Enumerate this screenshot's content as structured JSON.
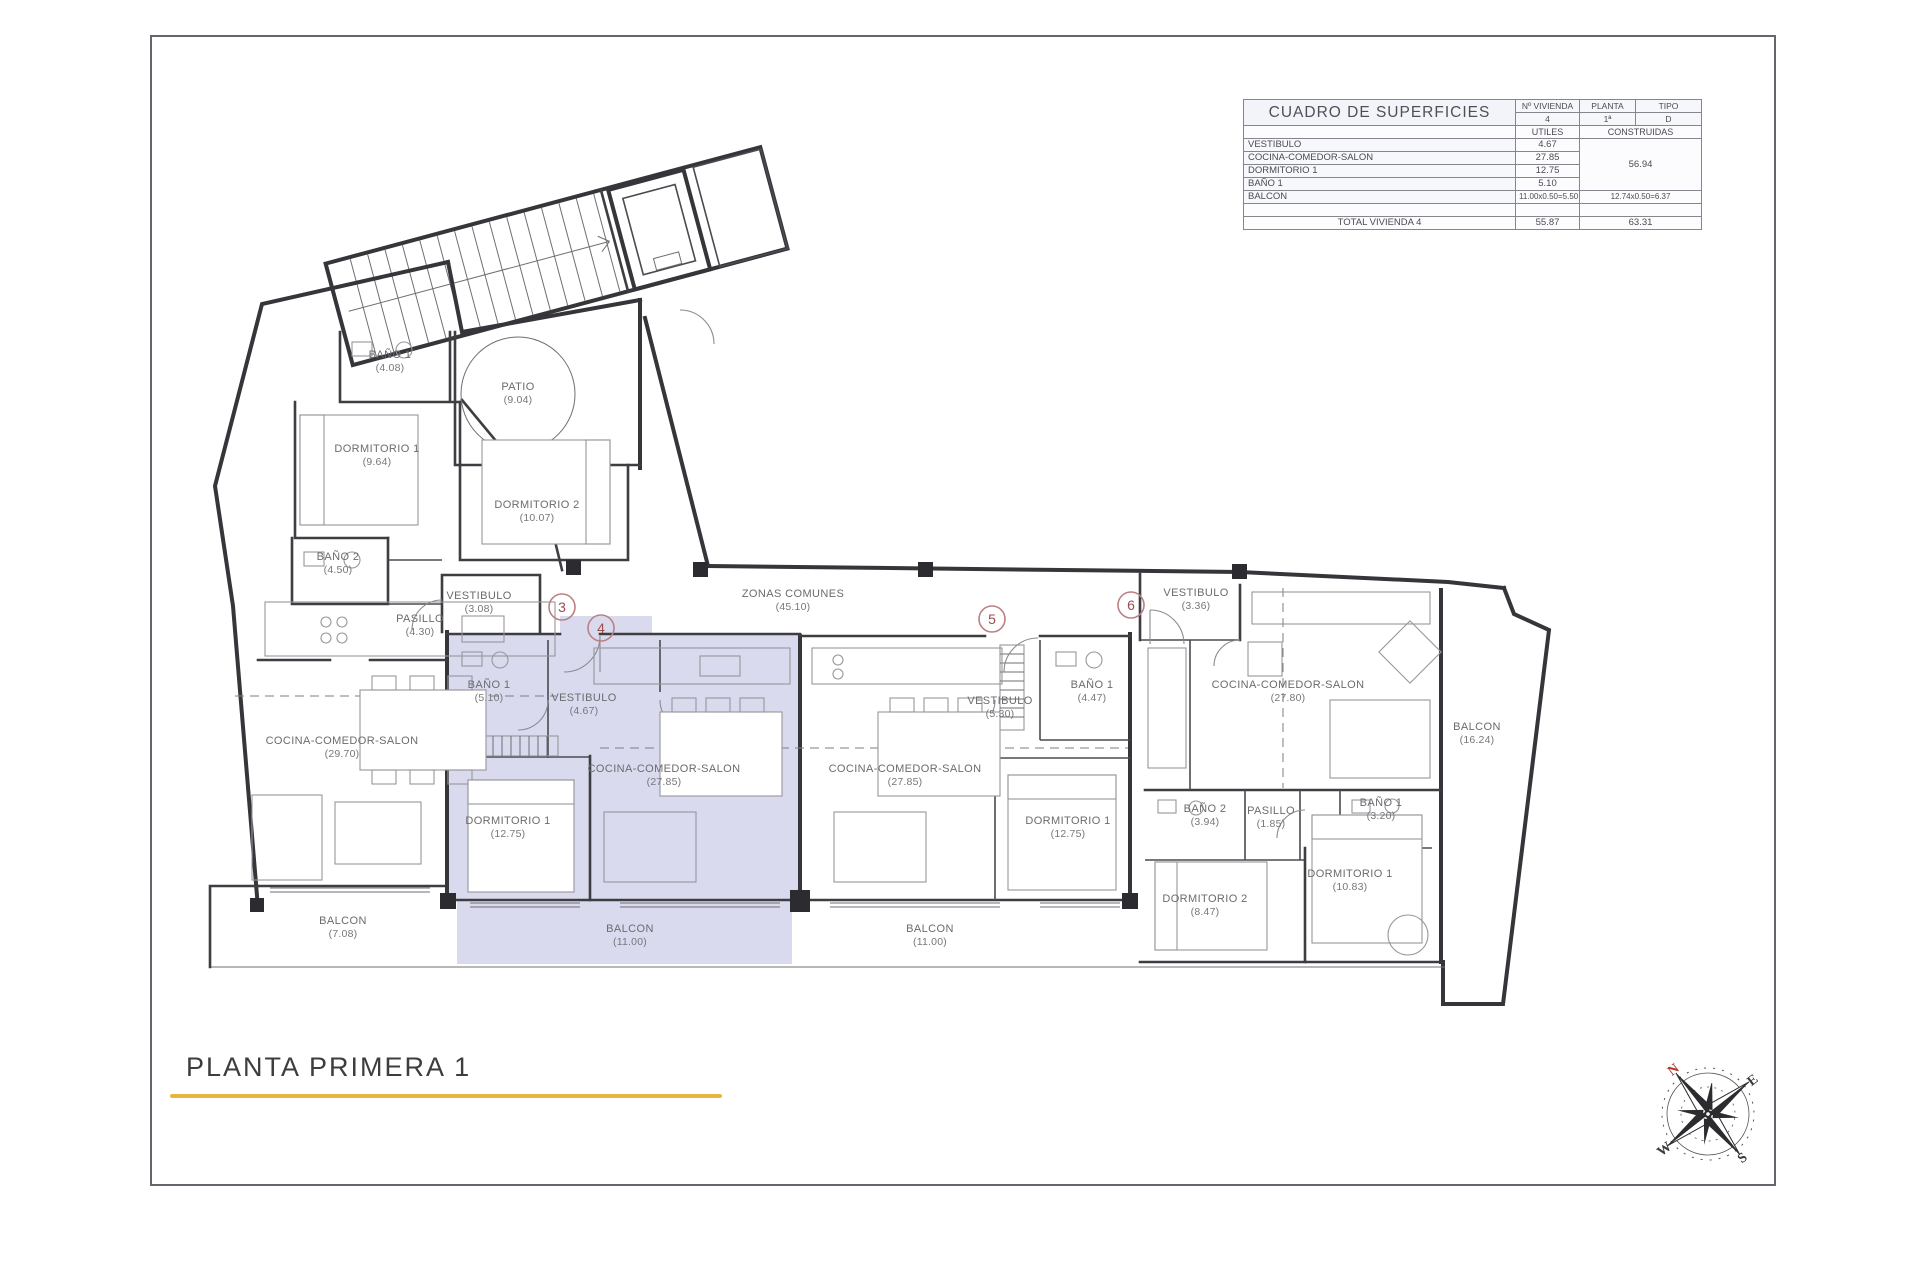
{
  "title_block": {
    "title": "PLANTA PRIMERA 1",
    "underline_color": "#e6b63d"
  },
  "surface_table": {
    "title": "CUADRO DE SUPERFICIES",
    "col_headers": [
      "Nº VIVIENDA",
      "PLANTA",
      "TIPO"
    ],
    "col_values": [
      "4",
      "1ª",
      "D"
    ],
    "subheaders": [
      "UTILES",
      "CONSTRUIDAS"
    ],
    "rows": [
      {
        "name": "VESTIBULO",
        "utiles": "4.67"
      },
      {
        "name": "COCINA-COMEDOR-SALON",
        "utiles": "27.85"
      },
      {
        "name": "DORMITORIO 1",
        "utiles": "12.75"
      },
      {
        "name": "BAÑO 1",
        "utiles": "5.10"
      }
    ],
    "construidas_merged": "56.94",
    "balcon_row": {
      "name": "BALCON",
      "utiles": "11.00x0.50=5.50",
      "construidas": "12.74x0.50=6.37"
    },
    "total_row": {
      "label": "TOTAL VIVIENDA 4",
      "utiles": "55.87",
      "construidas": "63.31"
    }
  },
  "floor_plan": {
    "highlight_color": "#d9daee",
    "rooms": [
      {
        "name": "BAÑO 1",
        "area": "4.08",
        "x": 390,
        "y": 358
      },
      {
        "name": "PATIO",
        "area": "9.04",
        "x": 518,
        "y": 390
      },
      {
        "name": "DORMITORIO 1",
        "area": "9.64",
        "x": 377,
        "y": 452
      },
      {
        "name": "DORMITORIO 2",
        "area": "10.07",
        "x": 537,
        "y": 508
      },
      {
        "name": "BAÑO 2",
        "area": "4.50",
        "x": 338,
        "y": 560
      },
      {
        "name": "VESTIBULO",
        "area": "3.08",
        "x": 479,
        "y": 599
      },
      {
        "name": "PASILLO",
        "area": "4.30",
        "x": 420,
        "y": 622
      },
      {
        "name": "ZONAS COMUNES",
        "area": "45.10",
        "x": 793,
        "y": 597
      },
      {
        "name": "COCINA-COMEDOR-SALON",
        "area": "29.70",
        "x": 342,
        "y": 744
      },
      {
        "name": "BAÑO 1",
        "area": "5.10",
        "x": 489,
        "y": 688
      },
      {
        "name": "VESTIBULO",
        "area": "4.67",
        "x": 584,
        "y": 701
      },
      {
        "name": "COCINA-COMEDOR-SALON",
        "area": "27.85",
        "x": 664,
        "y": 772
      },
      {
        "name": "DORMITORIO 1",
        "area": "12.75",
        "x": 508,
        "y": 824
      },
      {
        "name": "BALCON",
        "area": "11.00",
        "x": 630,
        "y": 932
      },
      {
        "name": "BALCON",
        "area": "7.08",
        "x": 343,
        "y": 924
      },
      {
        "name": "VESTIBULO",
        "area": "5.30",
        "x": 1000,
        "y": 704
      },
      {
        "name": "BAÑO 1",
        "area": "4.47",
        "x": 1092,
        "y": 688
      },
      {
        "name": "COCINA-COMEDOR-SALON",
        "area": "27.85",
        "x": 905,
        "y": 772
      },
      {
        "name": "DORMITORIO 1",
        "area": "12.75",
        "x": 1068,
        "y": 824
      },
      {
        "name": "BALCON",
        "area": "11.00",
        "x": 930,
        "y": 932
      },
      {
        "name": "VESTIBULO",
        "area": "3.36",
        "x": 1196,
        "y": 596
      },
      {
        "name": "COCINA-COMEDOR-SALON",
        "area": "27.80",
        "x": 1288,
        "y": 688
      },
      {
        "name": "BAÑO 2",
        "area": "3.94",
        "x": 1205,
        "y": 812
      },
      {
        "name": "PASILLO",
        "area": "1.85",
        "x": 1271,
        "y": 814
      },
      {
        "name": "BAÑO 1",
        "area": "3.20",
        "x": 1381,
        "y": 806
      },
      {
        "name": "DORMITORIO 2",
        "area": "8.47",
        "x": 1205,
        "y": 902
      },
      {
        "name": "DORMITORIO 1",
        "area": "10.83",
        "x": 1350,
        "y": 877
      },
      {
        "name": "BALCON",
        "area": "16.24",
        "x": 1477,
        "y": 730
      }
    ],
    "unit_markers": [
      {
        "label": "3",
        "x": 562,
        "y": 607
      },
      {
        "label": "4",
        "x": 601,
        "y": 628
      },
      {
        "label": "5",
        "x": 992,
        "y": 619
      },
      {
        "label": "6",
        "x": 1131,
        "y": 605
      }
    ]
  },
  "compass": {
    "n": "N",
    "e": "E",
    "s": "S",
    "w": "W",
    "north_color": "#b2372c"
  }
}
